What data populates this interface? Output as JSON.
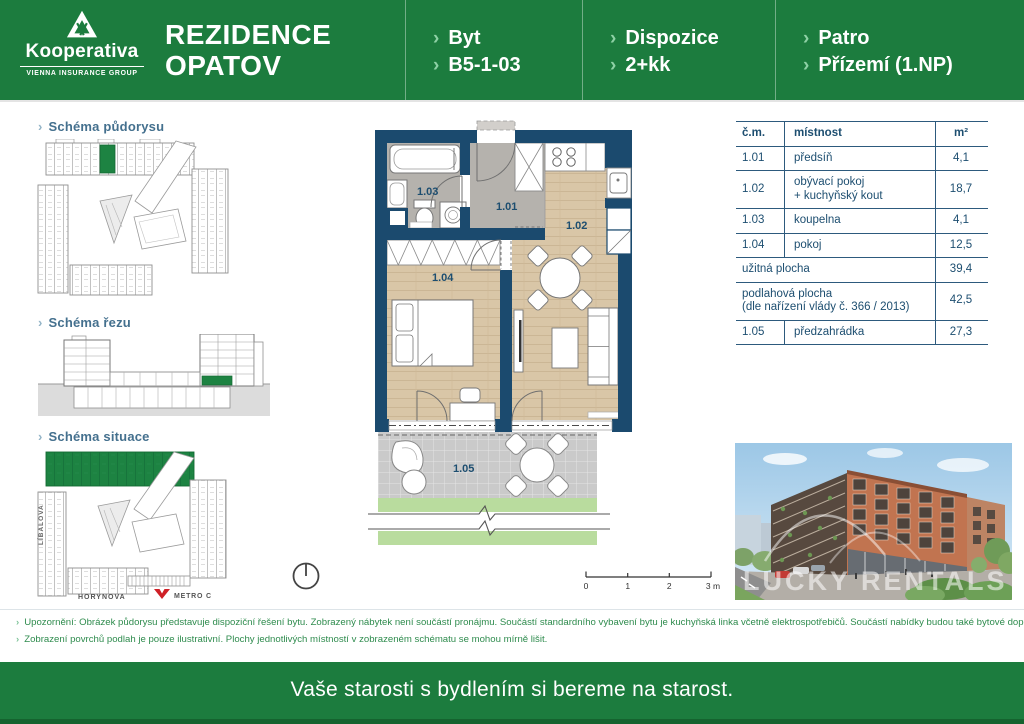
{
  "header": {
    "logo": {
      "brand": "Kooperativa",
      "group": "VIENNA INSURANCE GROUP"
    },
    "project_title": {
      "line1": "REZIDENCE",
      "line2": "OPATOV"
    },
    "segments": [
      {
        "label": "Byt",
        "value": "B5-1-03"
      },
      {
        "label": "Dispozice",
        "value": "2+kk"
      },
      {
        "label": "Patro",
        "value": "Přízemí (1.NP)"
      }
    ]
  },
  "sidebar": {
    "sections": [
      {
        "label": "Schéma půdorysu"
      },
      {
        "label": "Schéma řezu"
      },
      {
        "label": "Schéma situace"
      }
    ],
    "streets": {
      "left": "LÍBALOVA",
      "bottom": "HORYNOVA",
      "metro": "METRO C"
    }
  },
  "floorplan": {
    "rooms": {
      "hall": "1.01",
      "living": "1.02",
      "bathroom": "1.03",
      "bedroom": "1.04",
      "terrace": "1.05"
    },
    "scalebar": {
      "t0": "0",
      "t1": "1",
      "t2": "2",
      "t3": "3 m"
    }
  },
  "table": {
    "headers": {
      "no": "č.m.",
      "room": "místnost",
      "area": "m²"
    },
    "rows": [
      {
        "no": "1.01",
        "room": "předsíň",
        "area": "4,1"
      },
      {
        "no": "1.02",
        "room": "obývací pokoj\n+ kuchyňský kout",
        "area": "18,7"
      },
      {
        "no": "1.03",
        "room": "koupelna",
        "area": "4,1"
      },
      {
        "no": "1.04",
        "room": "pokoj",
        "area": "12,5"
      }
    ],
    "totals": [
      {
        "label": "užitná plocha",
        "area": "39,4"
      },
      {
        "label": "podlahová plocha\n(dle nařízení vlády č. 366 / 2013)",
        "area": "42,5"
      }
    ],
    "garden_row": {
      "no": "1.05",
      "room": "předzahrádka",
      "area": "27,3"
    }
  },
  "photo": {
    "watermark": "LUCKY RENTALS"
  },
  "disclaimer": {
    "line1": "Upozornění: Obrázek půdorysu představuje dispoziční řešení bytu. Zobrazený nábytek není součástí pronájmu. Součástí standardního vybavení bytu je kuchyňská linka včetně elektrospotřebičů. Součástí nabídky budou také bytové doplňky.",
    "line2": "Zobrazení povrchů podlah je pouze ilustrativní. Plochy jednotlivých místností v zobrazeném schématu se mohou mírně lišit."
  },
  "footer": {
    "slogan": "Vaše starosti s bydlením si bereme na starost."
  },
  "colors": {
    "brand_green": "#1c7c3e",
    "accent_light_green": "#8ed1a5",
    "plan_navy": "#1b4a6e",
    "table_navy": "#1d4e70",
    "highlight_green": "#1d8342",
    "metro_red": "#cf2027"
  }
}
